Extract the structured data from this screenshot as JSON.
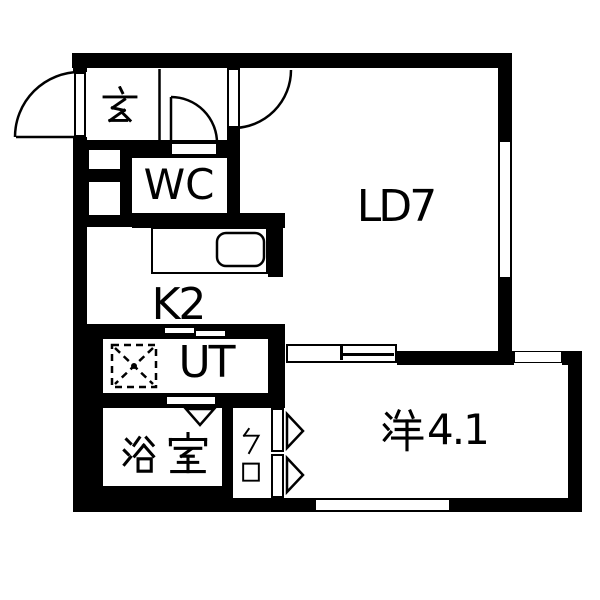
{
  "floorplan": {
    "type": "apartment-floor-plan",
    "colors": {
      "wall": "#000000",
      "floor": "#ffffff",
      "line": "#000000"
    },
    "rooms": [
      {
        "id": "genkan",
        "label": "玄"
      },
      {
        "id": "wc",
        "label": "WC"
      },
      {
        "id": "living",
        "label": "LD7"
      },
      {
        "id": "kitchen",
        "label": "K2"
      },
      {
        "id": "utility",
        "label": "UT"
      },
      {
        "id": "bathroom",
        "label": "浴室"
      },
      {
        "id": "closet",
        "label": "クロ"
      },
      {
        "id": "western",
        "label": "洋4.1",
        "label_kanji": "洋",
        "label_suffix": "4.1"
      }
    ]
  }
}
